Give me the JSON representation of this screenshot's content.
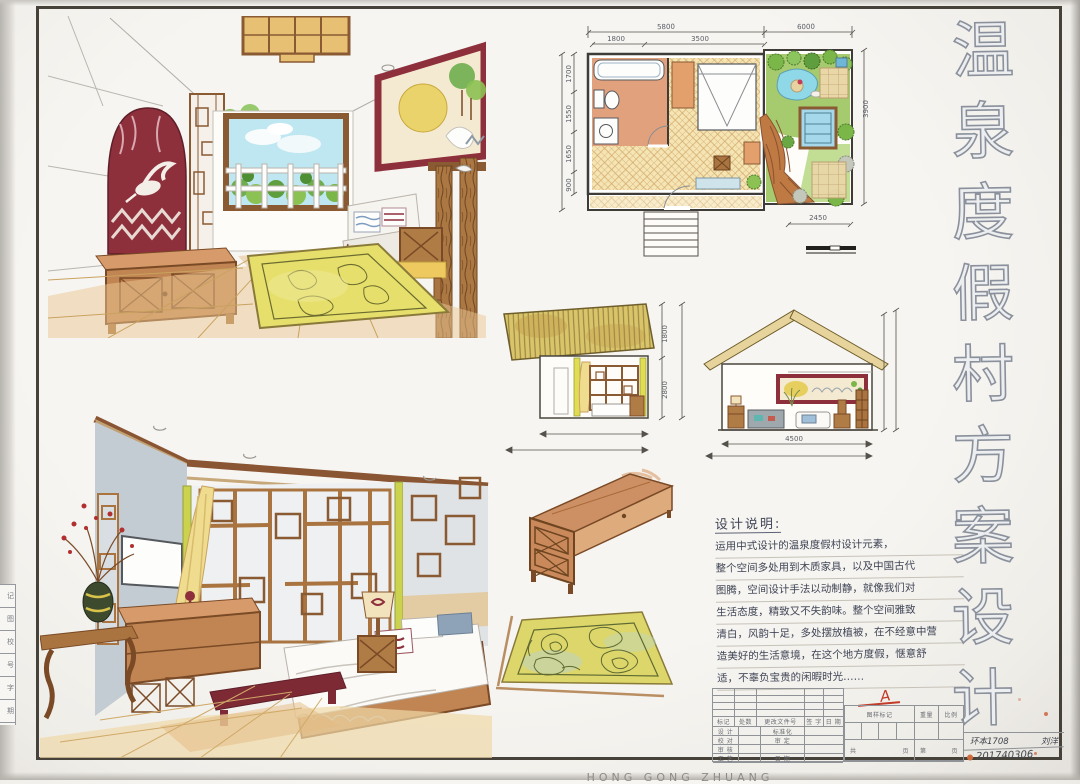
{
  "sheet": {
    "title_vertical": {
      "text": "温泉度假村方案设计",
      "chars": [
        "温",
        "泉",
        "度",
        "假",
        "村",
        "方",
        "案",
        "设",
        "计"
      ]
    },
    "watermark": "HONG GONG ZHUANG"
  },
  "design_notes": {
    "heading": "设计说明:",
    "lines": [
      "运用中式设计的温泉度假村设计元素，",
      "整个空间多处用到木质家具，以及中国古代",
      "图腾，空间设计手法以动制静，就像我们对",
      "生活态度，精致又不失韵味。整个空间雅致",
      "清白，风韵十足，多处摆放植被，在不经意中营",
      "造美好的生活意境，在这个地方度假，惬意舒",
      "适，不辜负宝贵的闲暇时光……"
    ]
  },
  "floor_plan": {
    "dims": {
      "top_overall_left": "5800",
      "top_overall_right": "6000",
      "top_sub_left": "1800",
      "top_sub_right": "3500",
      "left_segments": [
        "1700",
        "1550",
        "1650",
        "900"
      ],
      "right_overall": "3900",
      "bottom_garden": "2450"
    }
  },
  "elevation_bedroom": {
    "dims": {
      "upper": "1800",
      "lower": "2800"
    }
  },
  "elevation_section": {
    "dims": {
      "width": "4500"
    }
  },
  "title_block": {
    "rev_headers": [
      "标记",
      "处数",
      "更改文件号",
      "签 字",
      "日 期"
    ],
    "rows": [
      {
        "left": "设 计",
        "mid": "标准化"
      },
      {
        "left": "校 对",
        "mid": "审 定"
      },
      {
        "left": "审 核",
        "mid": ""
      },
      {
        "left": "工 艺",
        "mid": "日 期"
      }
    ],
    "stamp_header": "图样标记",
    "weight_header": "重量",
    "scale_header": "比例",
    "pages_total_prefix": "共",
    "pages_total_suffix": "页",
    "page_num_prefix": "第",
    "page_num_suffix": "页",
    "approval_mark": "A",
    "class_id": "环本1708",
    "author": "刘洋",
    "student_no": "201740306"
  },
  "edge_strip": {
    "cells": [
      "记",
      "图",
      "校",
      "号",
      "字",
      "期"
    ]
  },
  "colors": {
    "maroon_accent": "#8e2f3c",
    "wood": "#a9743f",
    "wood_dark": "#7a4a26",
    "tan_wash": "#ecc894",
    "rug_yellow": "#ddd66a",
    "leaf_green": "#7ab648",
    "sky_blue": "#aee4f0",
    "pool_blue": "#9fd6ea",
    "paper": "#f5f3ef",
    "frame_ink": "#46423a",
    "red_mark": "#c23a28"
  }
}
